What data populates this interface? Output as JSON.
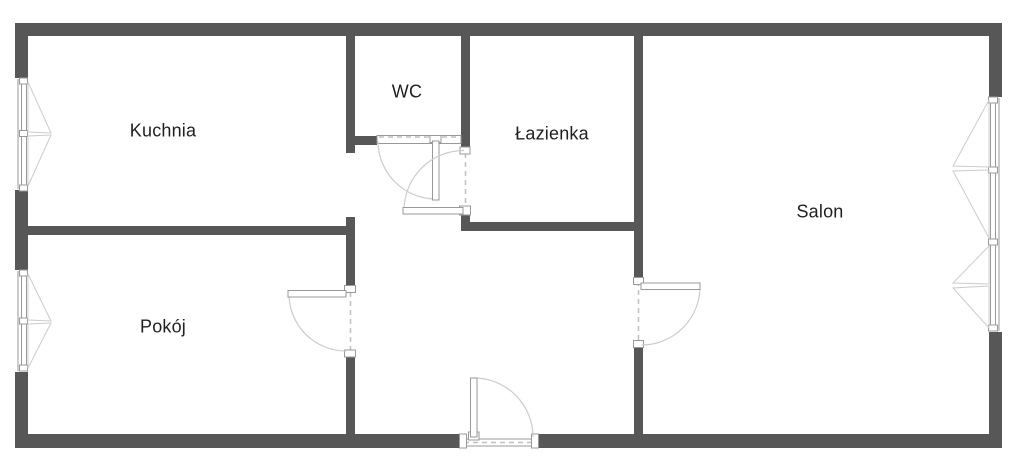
{
  "floorplan": {
    "rooms": {
      "kuchnia": {
        "label": "Kuchnia"
      },
      "wc": {
        "label": "WC"
      },
      "lazienka": {
        "label": "Łazienka"
      },
      "salon": {
        "label": "Salon"
      },
      "pokoj": {
        "label": "Pokój"
      }
    },
    "colors": {
      "wall": "#575757",
      "frame": "#999999",
      "swing": "#cccccc",
      "dash": "#c0c0c0",
      "text": "#1f1f1f",
      "background": "#ffffff"
    }
  }
}
